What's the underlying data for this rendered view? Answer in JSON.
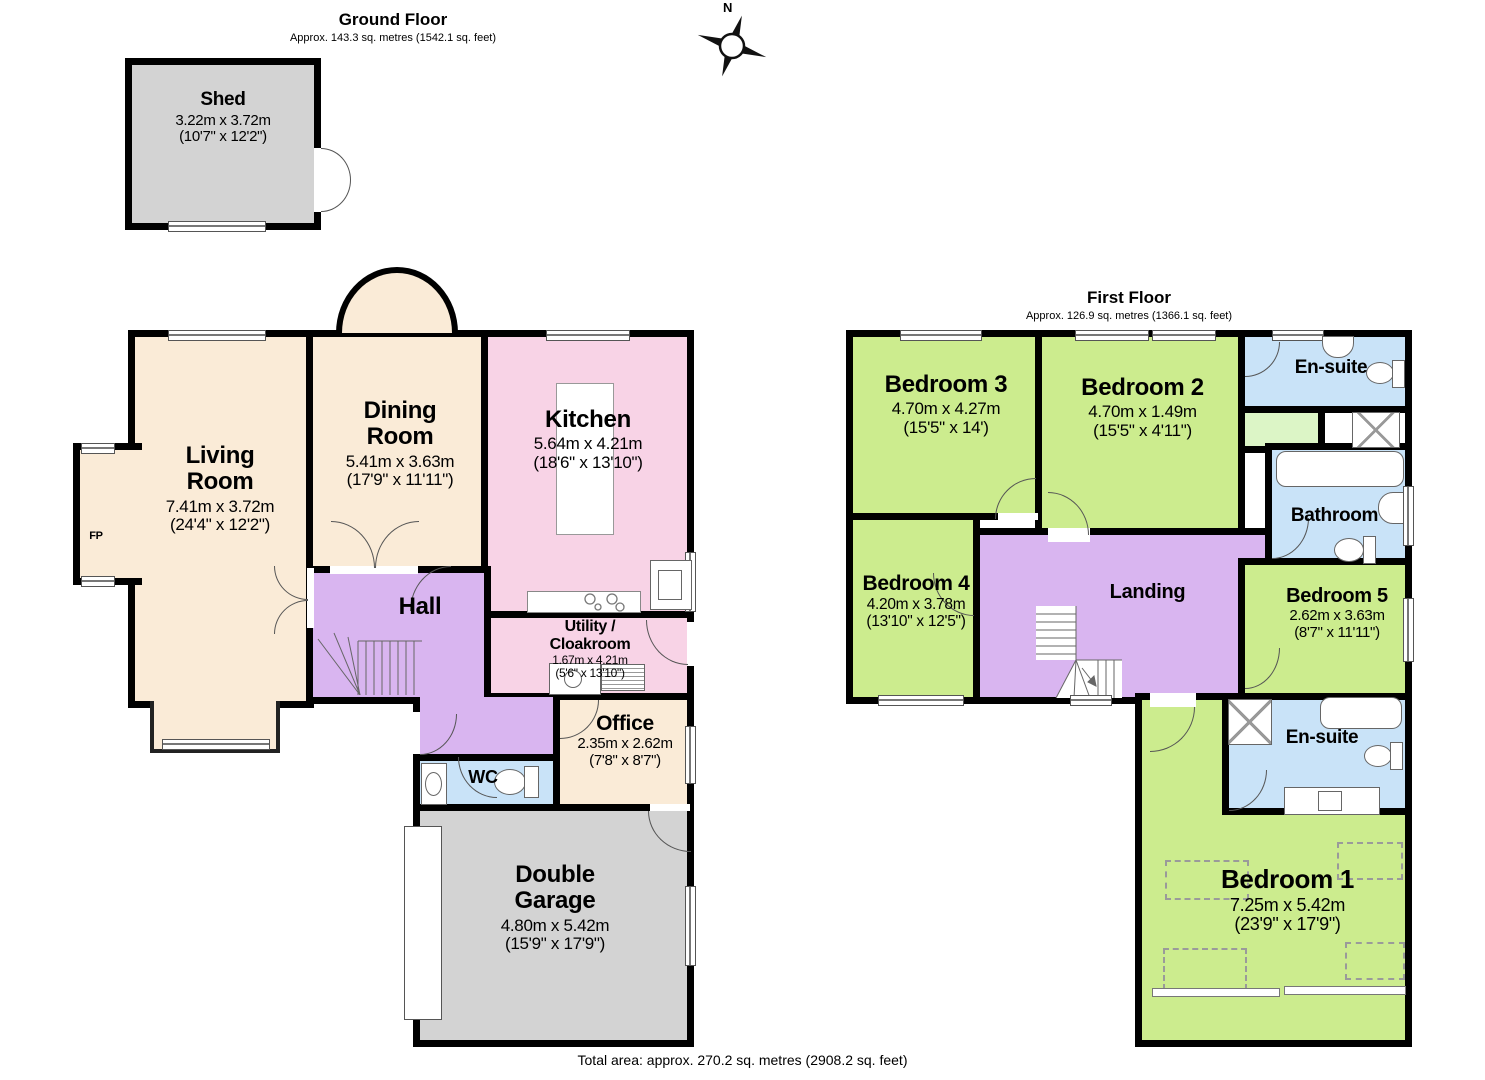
{
  "palette": {
    "wall": "#000000",
    "room_cream": "#FAEBD7",
    "room_pink": "#F8D3E6",
    "room_purple": "#D9B5F0",
    "room_green": "#CCEC8E",
    "room_pale_green": "#DCF5C6",
    "room_blue": "#C9E3F8",
    "room_gray": "#D3D3D3"
  },
  "compass": {
    "label": "N"
  },
  "ground_floor": {
    "title": "Ground Floor",
    "subtitle": "Approx. 143.3 sq. metres (1542.1 sq. feet)",
    "rooms": {
      "shed": {
        "name": "Shed",
        "dims_m": "3.22m x 3.72m",
        "dims_ft": "(10'7\" x 12'2\")"
      },
      "living_room": {
        "name": "Living\nRoom",
        "dims_m": "7.41m x 3.72m",
        "dims_ft": "(24'4\" x 12'2\")"
      },
      "fireplace": {
        "label": "FP"
      },
      "dining_room": {
        "name": "Dining\nRoom",
        "dims_m": "5.41m x 3.63m",
        "dims_ft": "(17'9\" x 11'11\")"
      },
      "kitchen": {
        "name": "Kitchen",
        "dims_m": "5.64m x 4.21m",
        "dims_ft": "(18'6\" x 13'10\")"
      },
      "hall": {
        "name": "Hall"
      },
      "utility": {
        "name": "Utility /\nCloakroom",
        "dims_m": "1.67m x 4.21m",
        "dims_ft": "(5'6\" x 13'10\")"
      },
      "wc": {
        "name": "WC"
      },
      "office": {
        "name": "Office",
        "dims_m": "2.35m x 2.62m",
        "dims_ft": "(7'8\" x 8'7\")"
      },
      "garage": {
        "name": "Double\nGarage",
        "dims_m": "4.80m x 5.42m",
        "dims_ft": "(15'9\" x 17'9\")"
      }
    }
  },
  "first_floor": {
    "title": "First Floor",
    "subtitle": "Approx. 126.9 sq. metres (1366.1 sq. feet)",
    "rooms": {
      "bedroom3": {
        "name": "Bedroom 3",
        "dims_m": "4.70m x 4.27m",
        "dims_ft": "(15'5\" x 14')"
      },
      "bedroom2": {
        "name": "Bedroom 2",
        "dims_m": "4.70m x 1.49m",
        "dims_ft": "(15'5\" x 4'11\")"
      },
      "ensuite_top": {
        "name": "En-suite"
      },
      "bathroom": {
        "name": "Bathroom"
      },
      "bedroom4": {
        "name": "Bedroom 4",
        "dims_m": "4.20m x 3.78m",
        "dims_ft": "(13'10\" x 12'5\")"
      },
      "landing": {
        "name": "Landing"
      },
      "bedroom5": {
        "name": "Bedroom 5",
        "dims_m": "2.62m x 3.63m",
        "dims_ft": "(8'7\" x 11'11\")"
      },
      "ensuite_bottom": {
        "name": "En-suite"
      },
      "bedroom1": {
        "name": "Bedroom 1",
        "dims_m": "7.25m x 5.42m",
        "dims_ft": "(23'9\" x 17'9\")"
      }
    }
  },
  "footer": {
    "total_area": "Total area: approx. 270.2 sq. metres (2908.2 sq. feet)"
  }
}
